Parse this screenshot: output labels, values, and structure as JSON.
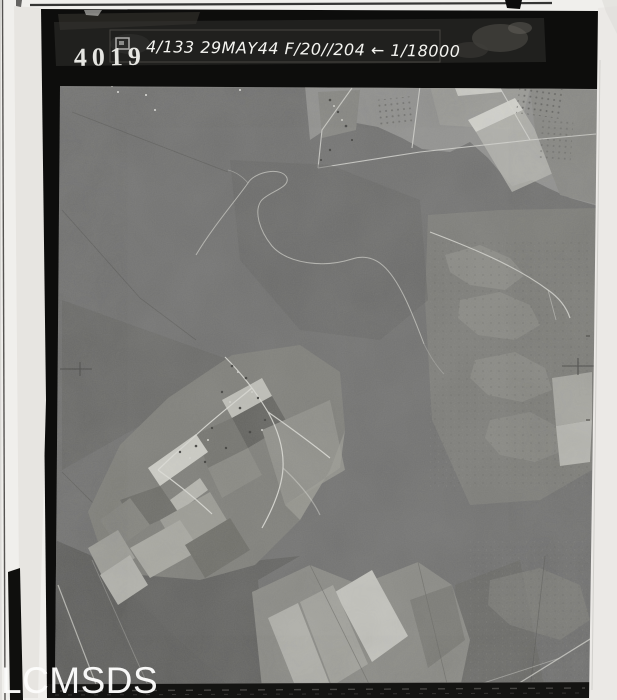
{
  "scan": {
    "id_stamp": "4019",
    "annotation": "4/133 29MAY44 F/20//204 ← 1/18000",
    "watermark": "LCMSDS"
  },
  "colors": {
    "page_background": "#f0efec",
    "border_strip": "#e7e5e1",
    "frame_black": "#0d0d0c",
    "annotation_tape": "#222220",
    "photo_base_gray": "#717170",
    "forest_dark_gray": "#5d5d5b",
    "field_light_gray": "#929290",
    "field_bright": "#d6d6d0",
    "road_white": "#e2e2dc",
    "stamp_white": "#e6e6e2",
    "watermark_white": "#fdfdfc"
  }
}
